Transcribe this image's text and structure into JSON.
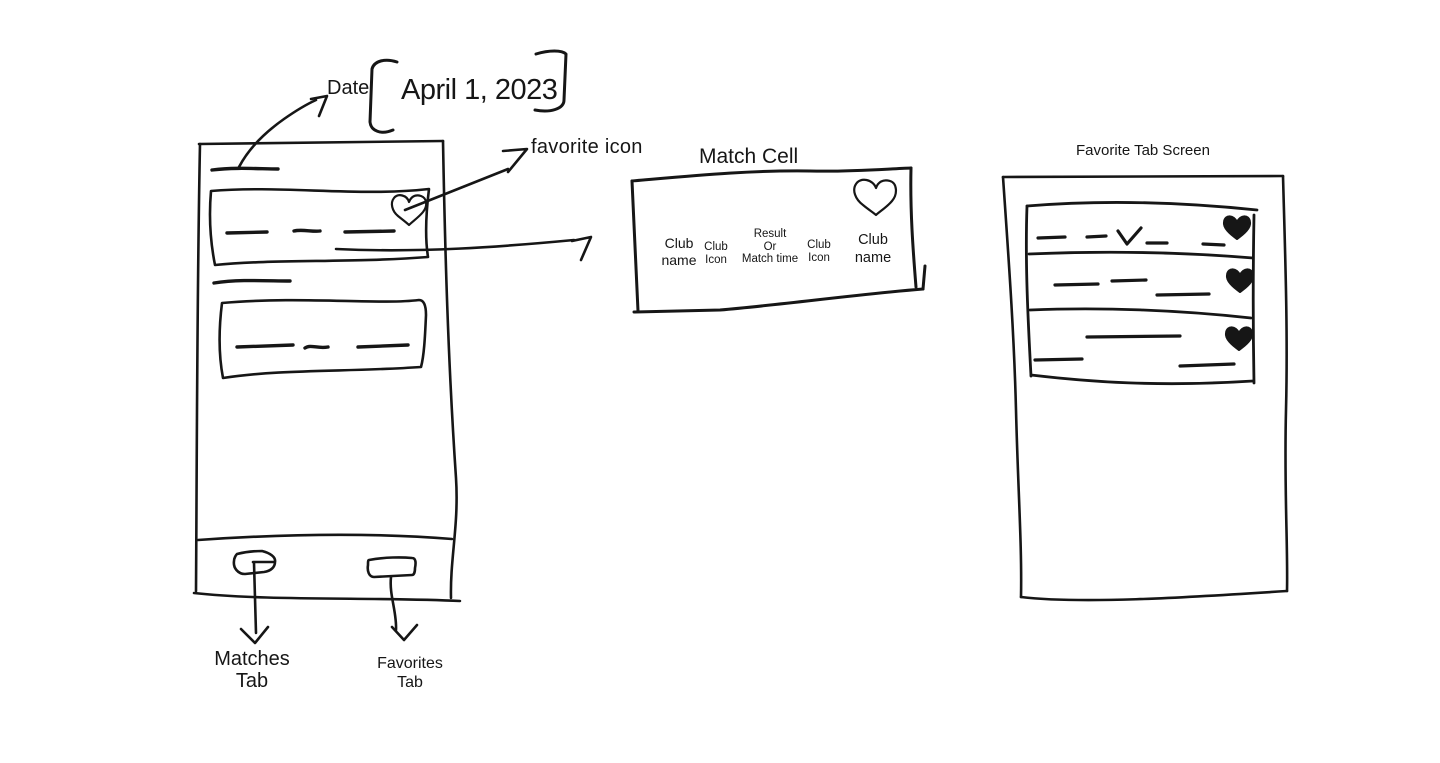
{
  "background": "#ffffff",
  "ink": "#161616",
  "annotations": {
    "date_label": "Date",
    "date_value": "April 1, 2023",
    "favorite_icon_label": "favorite icon"
  },
  "matches_screen": {
    "tabs": {
      "matches_label": [
        "Matches",
        "Tab"
      ],
      "favorites_label": [
        "Favorites",
        "Tab"
      ]
    },
    "match_cells_shown": 2
  },
  "match_cell": {
    "title": "Match Cell",
    "fields": {
      "left_club_name": [
        "Club",
        "name"
      ],
      "left_club_icon": [
        "Club",
        "Icon"
      ],
      "result_or_time": [
        "Result",
        "Or",
        "Match time"
      ],
      "right_club_icon": [
        "Club",
        "Icon"
      ],
      "right_club_name": [
        "Club",
        "name"
      ]
    },
    "icons": {
      "favorite": "heart-outline-icon"
    }
  },
  "favorites_screen": {
    "title": "Favorite Tab Screen",
    "favorited_rows": 3,
    "icons": {
      "favorite": "heart-filled-icon",
      "check": "checkmark-icon"
    }
  }
}
